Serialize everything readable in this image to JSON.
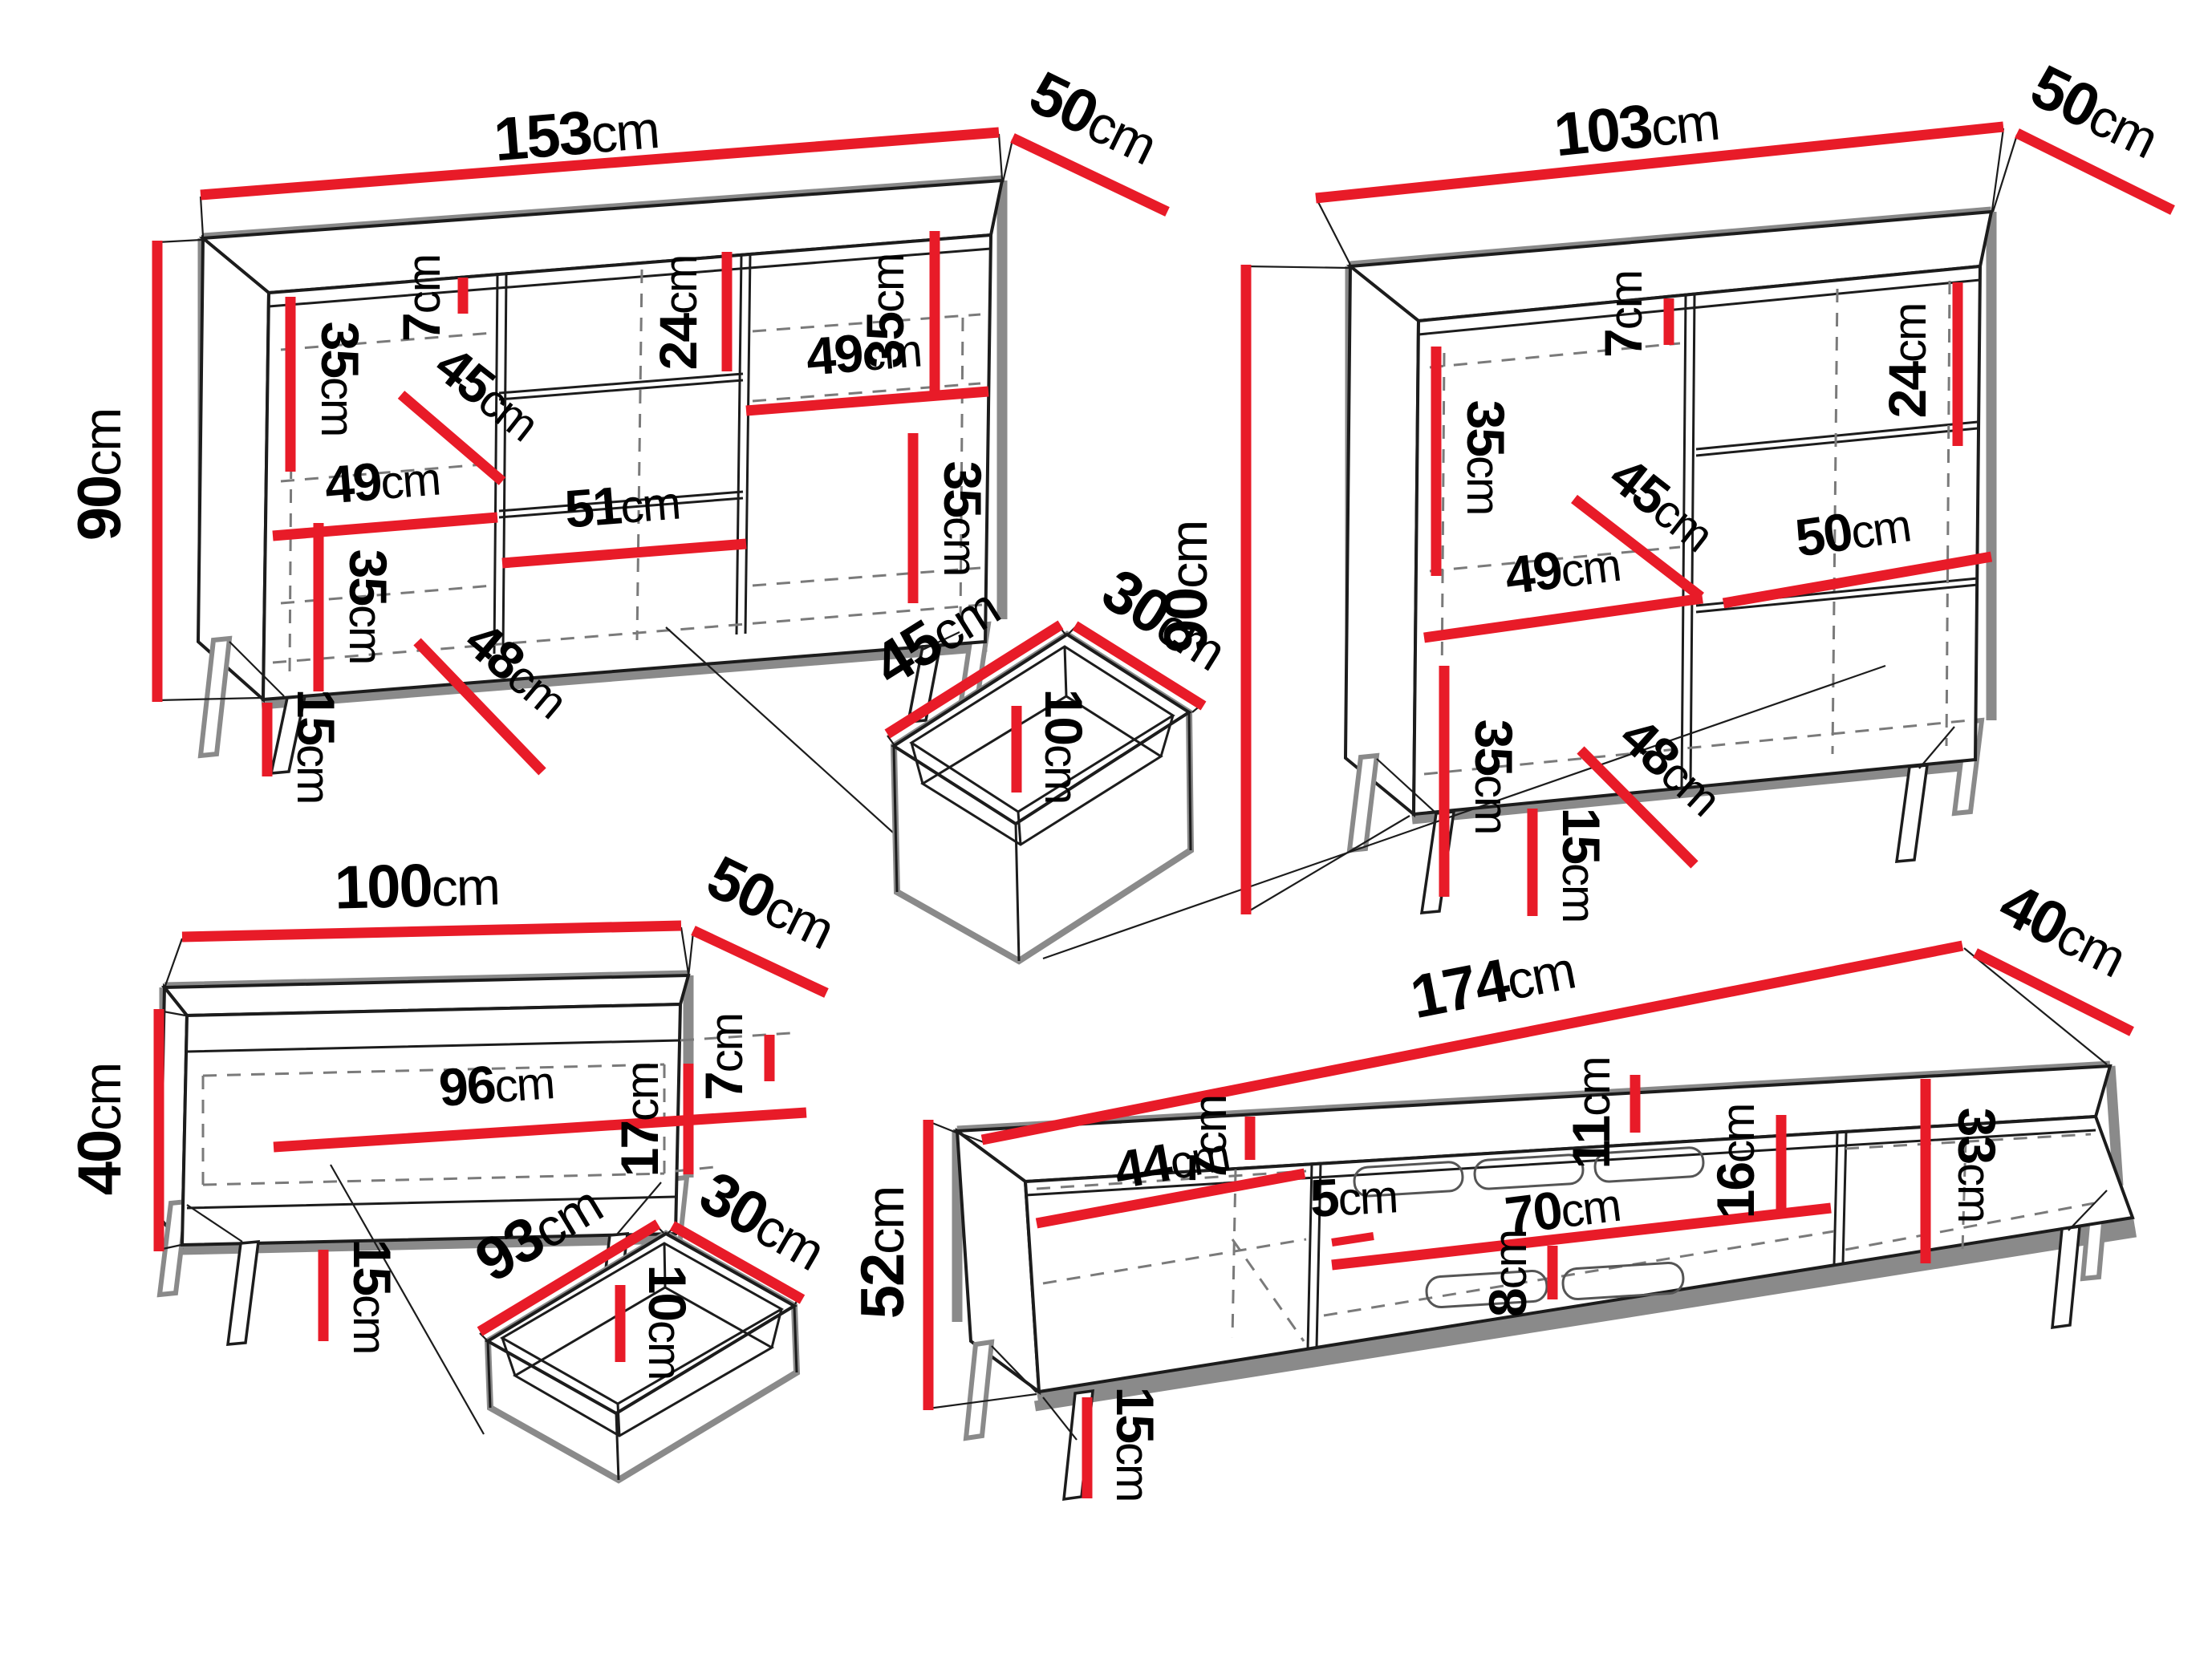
{
  "colors": {
    "background": "#ffffff",
    "dimension_red": "#e81b28",
    "outline_grey": "#8a8a8a",
    "edge_black": "#1c1c1c",
    "label_black": "#000000"
  },
  "furniture": [
    {
      "name": "sideboard-large",
      "dims": {
        "width": {
          "v": "153",
          "u": "cm"
        },
        "depth": {
          "v": "50",
          "u": "cm"
        },
        "height": {
          "v": "90",
          "u": "cm"
        },
        "upper_left_shelf": {
          "v": "35",
          "u": "cm"
        },
        "top_gap": {
          "v": "7",
          "u": "cm"
        },
        "drawer_front": {
          "v": "24",
          "u": "cm"
        },
        "upper_right_shelf": {
          "v": "35",
          "u": "cm"
        },
        "interior_depth": {
          "v": "45",
          "u": "cm"
        },
        "left_door_width": {
          "v": "49",
          "u": "cm"
        },
        "middle_width": {
          "v": "51",
          "u": "cm"
        },
        "right_door_width": {
          "v": "49",
          "u": "cm"
        },
        "lower_right_shelf": {
          "v": "35",
          "u": "cm"
        },
        "lower_left_shelf": {
          "v": "35",
          "u": "cm"
        },
        "lower_interior_depth": {
          "v": "48",
          "u": "cm"
        },
        "leg_height": {
          "v": "15",
          "u": "cm"
        }
      }
    },
    {
      "name": "sideboard-small",
      "dims": {
        "width": {
          "v": "103",
          "u": "cm"
        },
        "depth": {
          "v": "50",
          "u": "cm"
        },
        "height": {
          "v": "90",
          "u": "cm"
        },
        "top_gap": {
          "v": "7",
          "u": "cm"
        },
        "upper_shelf": {
          "v": "35",
          "u": "cm"
        },
        "interior_depth": {
          "v": "45",
          "u": "cm"
        },
        "door_width": {
          "v": "49",
          "u": "cm"
        },
        "drawer_front": {
          "v": "24",
          "u": "cm"
        },
        "drawer_width": {
          "v": "50",
          "u": "cm"
        },
        "lower_shelf": {
          "v": "35",
          "u": "cm"
        },
        "lower_interior_depth": {
          "v": "48",
          "u": "cm"
        },
        "leg_height": {
          "v": "15",
          "u": "cm"
        }
      }
    },
    {
      "name": "drawer-box-small",
      "dims": {
        "width": {
          "v": "45",
          "u": "cm"
        },
        "depth": {
          "v": "30",
          "u": "cm"
        },
        "height": {
          "v": "10",
          "u": "cm"
        }
      }
    },
    {
      "name": "coffee-table",
      "dims": {
        "width": {
          "v": "100",
          "u": "cm"
        },
        "depth": {
          "v": "50",
          "u": "cm"
        },
        "height": {
          "v": "40",
          "u": "cm"
        },
        "interior_width": {
          "v": "96",
          "u": "cm"
        },
        "top_rail": {
          "v": "7",
          "u": "cm"
        },
        "interior_height": {
          "v": "17",
          "u": "cm"
        },
        "leg_height": {
          "v": "15",
          "u": "cm"
        }
      }
    },
    {
      "name": "drawer-box-large",
      "dims": {
        "width": {
          "v": "93",
          "u": "cm"
        },
        "depth": {
          "v": "30",
          "u": "cm"
        },
        "height": {
          "v": "10",
          "u": "cm"
        }
      }
    },
    {
      "name": "tv-stand",
      "dims": {
        "width": {
          "v": "174",
          "u": "cm"
        },
        "depth": {
          "v": "40",
          "u": "cm"
        },
        "height": {
          "v": "52",
          "u": "cm"
        },
        "left_niche_width": {
          "v": "44",
          "u": "cm"
        },
        "top_gap": {
          "v": "7",
          "u": "cm"
        },
        "middle_niche_width": {
          "v": "70",
          "u": "cm"
        },
        "vent_top_offset": {
          "v": "11",
          "u": "cm"
        },
        "vent_height": {
          "v": "16",
          "u": "cm"
        },
        "divider_gap": {
          "v": "5",
          "u": "cm"
        },
        "bottom_offset": {
          "v": "8",
          "u": "cm"
        },
        "right_niche_height": {
          "v": "33",
          "u": "cm"
        },
        "leg_height": {
          "v": "15",
          "u": "cm"
        }
      }
    }
  ]
}
